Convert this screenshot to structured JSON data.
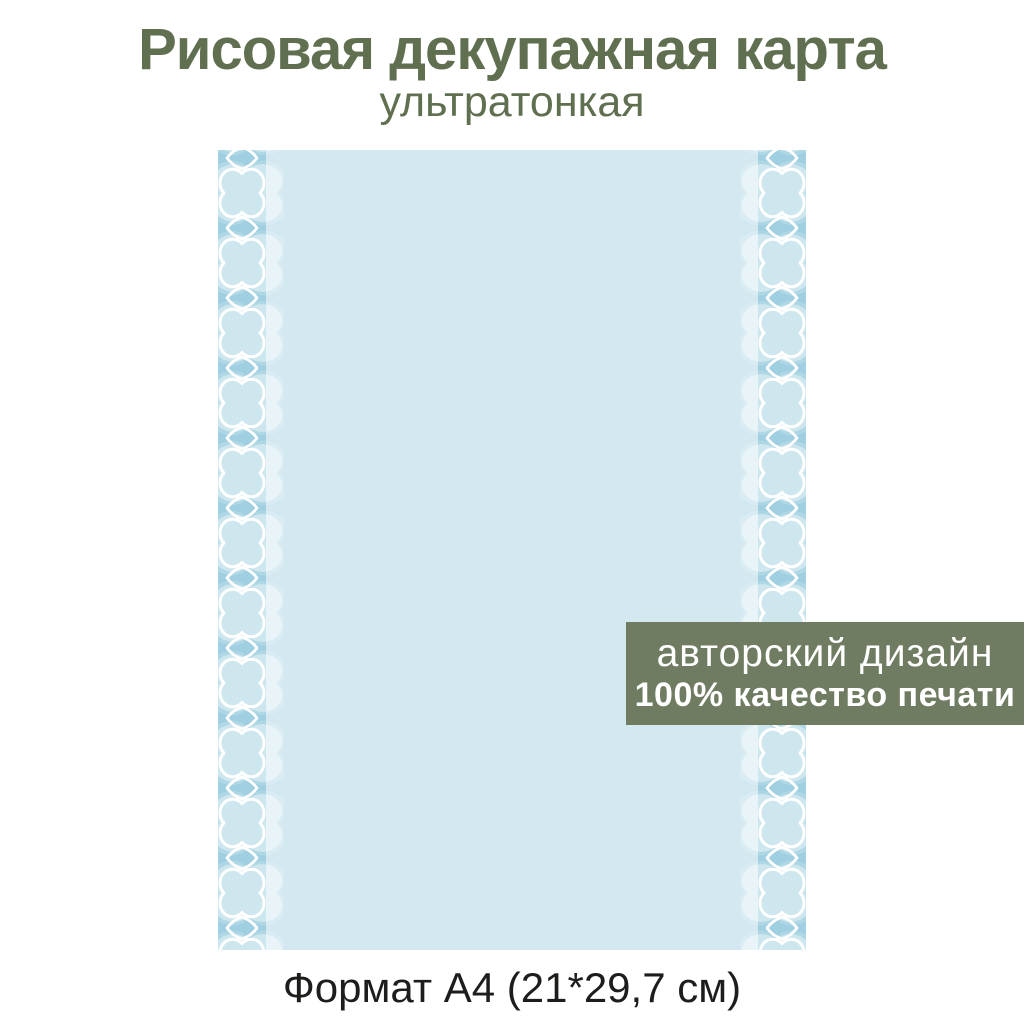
{
  "title": "Рисовая декупажная карта",
  "subtitle": "ультратонкая",
  "banner": {
    "line1": "авторский дизайн",
    "line2": "100% качество печати"
  },
  "footer": {
    "text": "Формат А4 (21*29,7 см)"
  },
  "card": {
    "pattern": "quatrefoil-and-diamond-border"
  },
  "colors": {
    "c-title": "#5f6f50",
    "c-banner": "#6f7c62",
    "c-banner-text": "#ffffff",
    "c-card": "#d3e8f1",
    "c-strip": "#9fcfe0",
    "c-outline": "#ffffff",
    "c-footer": "#1d1d1b",
    "c-bg": "#ffffff"
  }
}
